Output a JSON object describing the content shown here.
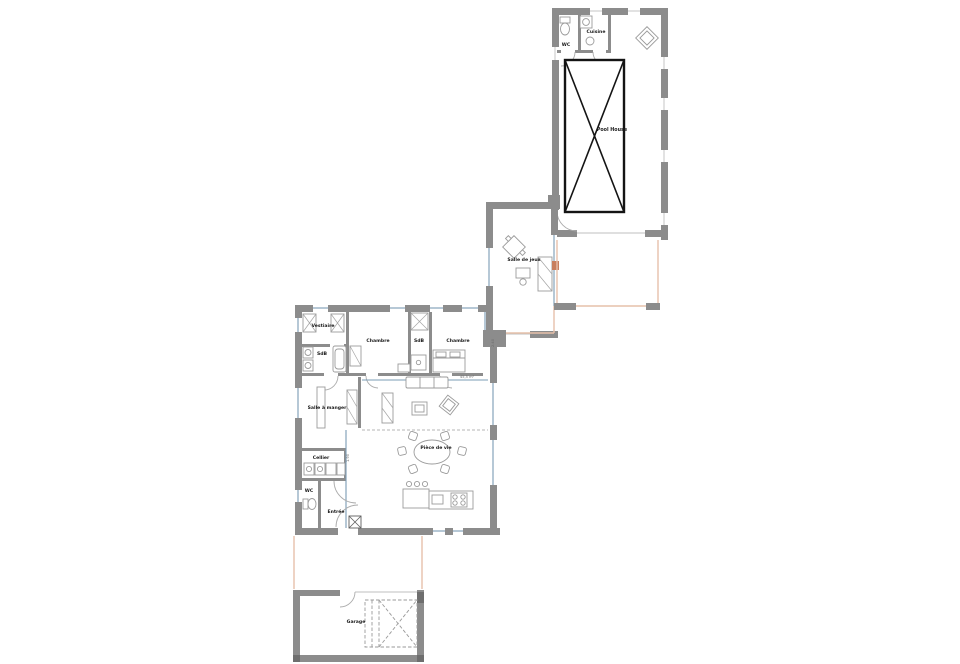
{
  "document": {
    "type": "architectural-floor-plan",
    "background": "#ffffff"
  },
  "colors": {
    "wall": "#8c8c8c",
    "wall_dark": "#6e6e6e",
    "glass_line": "#7b9cb5",
    "terrace_outline": "#e6c0aa",
    "pool_outline": "#141414",
    "furniture_line": "#9b9b9b",
    "stove_accent": "#c87f5f",
    "text": "#1a1a1a"
  },
  "pool_house": {
    "label": "Pool House",
    "wc": "WC",
    "kitchen": "Cuisine"
  },
  "game_room": {
    "label": "Salle de jeux"
  },
  "house": {
    "vestiaire": "Vestiaire",
    "bath1": "SdB",
    "bedroom1": "Chambre",
    "bath2": "SdB",
    "bedroom2": "Chambre",
    "dining": "Salle à manger",
    "pantry": "Cellier",
    "wc": "WC",
    "entry": "Entrée",
    "living": "Pièce de vie",
    "area_note": "45,5 m²",
    "dim_corridor": "1.90",
    "dim_east": "2.40"
  },
  "garage": {
    "label": "Garage"
  }
}
